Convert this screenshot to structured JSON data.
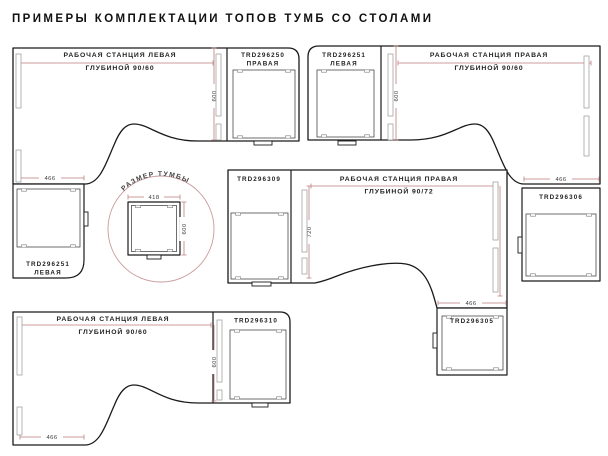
{
  "title": "ПРИМЕРЫ КОМПЛЕКТАЦИИ ТОПОВ ТУМБ СО СТОЛАМИ",
  "colors": {
    "line": "#1a1a1a",
    "dimension": "#bf7d7d",
    "detail_circle": "#c99a9a"
  },
  "stations": {
    "s1": {
      "name": "РАБОЧАЯ СТАНЦИЯ ЛЕВАЯ",
      "depth_prefix": "ГЛУБИНОЙ 90/",
      "depth_bold": "60",
      "top_code": "TRD296250",
      "top_side": "ПРАВАЯ",
      "low_code": "TRD296251",
      "low_side": "ЛЕВАЯ",
      "dim_depth": "600",
      "dim_width": "466"
    },
    "s2": {
      "name": "РАБОЧАЯ СТАНЦИЯ ПРАВАЯ",
      "depth_prefix": "ГЛУБИНОЙ 90/",
      "depth_bold": "60",
      "top_code": "TRD296251",
      "top_side": "ЛЕВАЯ",
      "low_code": "TRD296306",
      "dim_depth": "600",
      "dim_width": "466"
    },
    "s3": {
      "name": "РАБОЧАЯ СТАНЦИЯ ПРАВАЯ",
      "depth_prefix": "ГЛУБИНОЙ 90/",
      "depth_bold": "72",
      "left_code": "TRD296309",
      "low_code": "TRD296305",
      "dim_depth": "720",
      "dim_width": "466"
    },
    "s4": {
      "name": "РАБОЧАЯ СТАНЦИЯ ЛЕВАЯ",
      "depth_prefix": "ГЛУБИНОЙ 90/",
      "depth_bold": "60",
      "right_code": "TRD296310",
      "dim_depth": "600",
      "dim_width": "466"
    }
  },
  "detail": {
    "label": "РАЗМЕР ТУМБЫ",
    "width": "418",
    "depth": "600"
  }
}
